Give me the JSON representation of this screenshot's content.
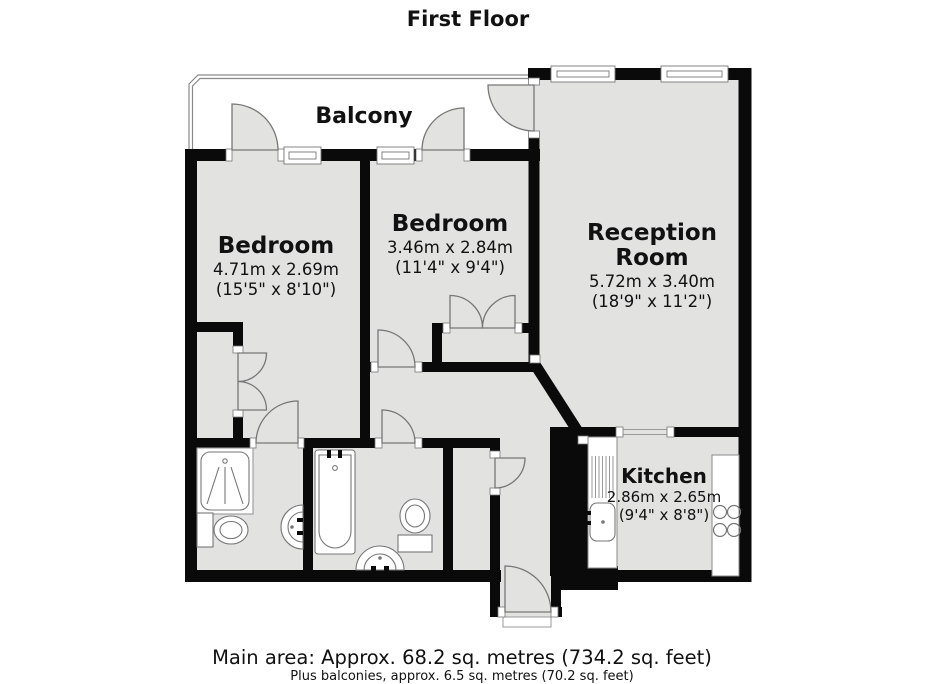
{
  "title": "First Floor",
  "balcony": {
    "label": "Balcony"
  },
  "rooms": {
    "bedroom1": {
      "name": "Bedroom",
      "metric": "4.71m x 2.69m",
      "imperial": "(15'5\" x 8'10\")"
    },
    "bedroom2": {
      "name": "Bedroom",
      "metric": "3.46m x 2.84m",
      "imperial": "(11'4\" x 9'4\")"
    },
    "reception": {
      "name_line1": "Reception",
      "name_line2": "Room",
      "metric": "5.72m x 3.40m",
      "imperial": "(18'9\" x 11'2\")"
    },
    "kitchen": {
      "name": "Kitchen",
      "metric": "2.86m x 2.65m",
      "imperial": "(9'4\" x 8'8\")"
    }
  },
  "footer": {
    "main_area": "Main area: Approx. 68.2 sq. metres (734.2 sq. feet)",
    "balconies_note": "Plus balconies, approx. 6.5 sq. metres (70.2 sq. feet)"
  },
  "colors": {
    "wall": "#0a0a0a",
    "room_fill": "#e2e2e1",
    "outline": "#7a7a7a"
  }
}
